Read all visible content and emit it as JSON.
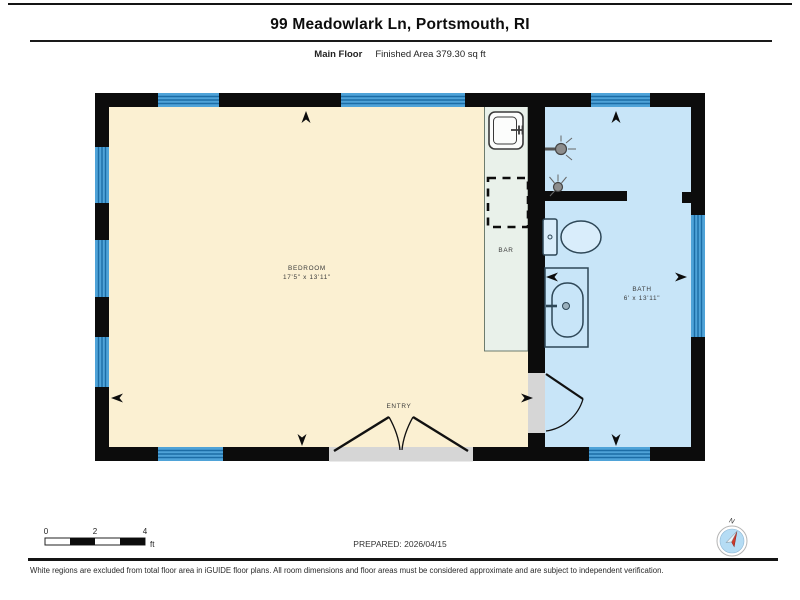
{
  "header": {
    "title": "99 Meadowlark Ln, Portsmouth, RI",
    "floor_label": "Main Floor",
    "finished_area": "Finished Area 379.30 sq ft"
  },
  "rooms": {
    "bedroom": {
      "name": "BEDROOM",
      "dimensions": "17'5\" x 13'11\""
    },
    "bar": {
      "name": "BAR"
    },
    "bath": {
      "name": "BATH",
      "dimensions": "6' x 13'11\""
    },
    "entry": {
      "name": "ENTRY"
    }
  },
  "scale_bar": {
    "tick_labels": [
      "0",
      "2",
      "4"
    ],
    "unit": "ft"
  },
  "compass": {
    "north_label": "N"
  },
  "footer": {
    "prepared": "PREPARED: 2026/04/15",
    "disclaimer": "White regions are excluded from total floor area in iGUIDE floor plans. All room dimensions and floor areas must be considered approximate and are subject to independent verification."
  },
  "colors": {
    "wall": "#0c0c0c",
    "bedroom_fill": "#fbf0d2",
    "bar_fill": "#e9f1ea",
    "bath_fill": "#c8e5f8",
    "window_fill": "#4fa3d8",
    "window_stripe": "#1c6da6",
    "threshold_gray": "#d6d6d6",
    "fixture_stroke": "#2e4757",
    "compass_needle_red": "#d03a2a"
  }
}
